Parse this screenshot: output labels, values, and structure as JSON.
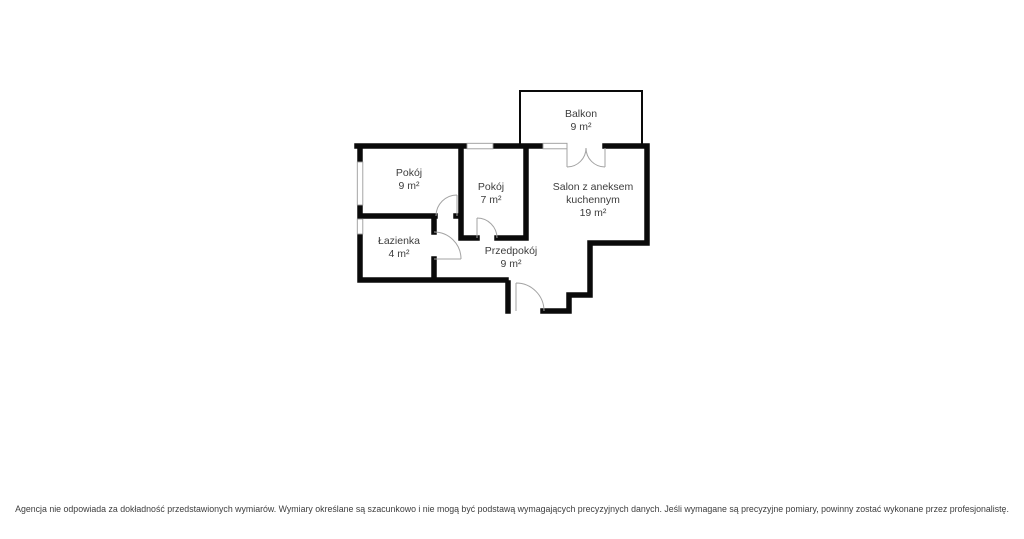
{
  "colors": {
    "wall": "#0a0a0a",
    "door_line": "#a3a3a3",
    "window_stroke": "#9a9a9a",
    "text": "#3d3d3d",
    "bg": "#ffffff"
  },
  "floor_plan": {
    "rooms": [
      {
        "id": "balkon",
        "lines": [
          "Balkon",
          "9 m²"
        ]
      },
      {
        "id": "pokoj-9",
        "lines": [
          "Pokój",
          "9 m²"
        ]
      },
      {
        "id": "pokoj-7",
        "lines": [
          "Pokój",
          "7 m²"
        ]
      },
      {
        "id": "salon",
        "lines": [
          "Salon z aneksem",
          "kuchennym",
          "19 m²"
        ]
      },
      {
        "id": "lazienka",
        "lines": [
          "Łazienka",
          "4 m²"
        ]
      },
      {
        "id": "przedpokoj",
        "lines": [
          "Przedpokój",
          "9 m²"
        ]
      }
    ]
  },
  "disclaimer": "Agencja nie odpowiada za dokładność przedstawionych wymiarów. Wymiary określane są szacunkowo i nie mogą być podstawą wymagających precyzyjnych danych. Jeśli wymagane są precyzyjne pomiary, powinny zostać wykonane przez profesjonalistę."
}
